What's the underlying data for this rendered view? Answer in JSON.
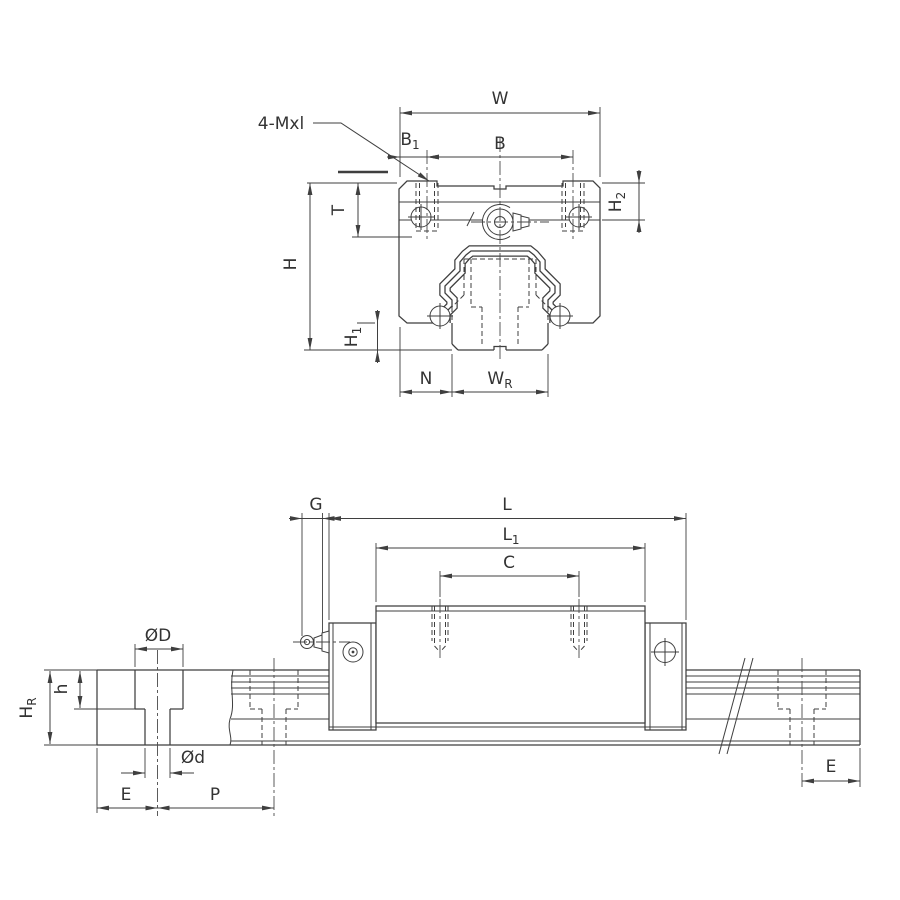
{
  "front_view": {
    "thread_note": "4-Mxl",
    "dims": {
      "w": "W",
      "b": "B",
      "b1": {
        "main": "B",
        "sub": "1"
      },
      "h2": {
        "main": "H",
        "sub": "2"
      },
      "t": "T",
      "h": "H",
      "h1": {
        "main": "H",
        "sub": "1"
      },
      "n": "N",
      "wr": {
        "main": "W",
        "sub": "R"
      }
    }
  },
  "side_view": {
    "dims": {
      "g": "G",
      "l": "L",
      "l1": {
        "main": "L",
        "sub": "1"
      },
      "c": "C",
      "od": "ØD",
      "h": "h",
      "hr": {
        "main": "H",
        "sub": "R"
      },
      "od_small": "Ød",
      "e_left": "E",
      "p": "P",
      "e_right": "E"
    }
  },
  "colors": {
    "line": "#3f3f3f",
    "text": "#333333",
    "background": "#ffffff"
  }
}
